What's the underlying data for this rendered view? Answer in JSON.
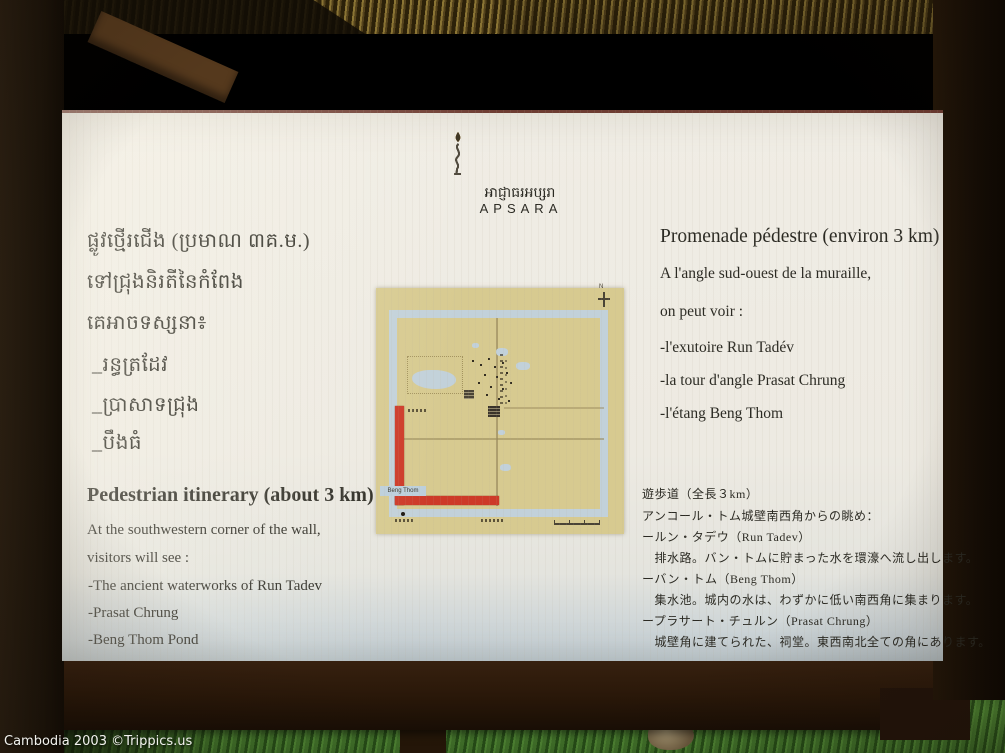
{
  "watermark": "Cambodia 2003 ©Trippics.us",
  "sign": {
    "logo": {
      "khmer_name": "អាជ្ញាធរអប្សរា",
      "latin_name": "APSARA",
      "drop_colors": [
        "#2e2e3c",
        "#d18a2e",
        "#2f4d28",
        "#c47a2e",
        "#3a321f"
      ]
    },
    "khmer": {
      "title": "ផ្លូវថ្មើរជើង (ប្រមាណ ៣គ.ម.)",
      "line2": "ទៅជ្រុងនិរតីនៃកំពែង",
      "line3": "គេអាចទស្សនា៖",
      "item1": "_រន្ធត្រដែវ",
      "item2": "_ប្រាសាទជ្រុង",
      "item3": "_បឹងធំ"
    },
    "french": {
      "title": "Promenade pédestre (environ 3 km)",
      "line1": "A l'angle sud-ouest de la muraille,",
      "line2": "on peut voir :",
      "item1": "-l'exutoire Run Tadév",
      "item2": "-la tour d'angle Prasat Chrung",
      "item3": "-l'étang Beng Thom"
    },
    "english": {
      "title": "Pedestrian itinerary (about 3 km)",
      "line1": "At the southwestern corner of the wall,",
      "line2": "visitors will see :",
      "item1": "-The ancient waterworks of Run Tadev",
      "item2": "-Prasat Chrung",
      "item3": "-Beng Thom Pond"
    },
    "japanese": {
      "title": "遊歩道（全長３km）",
      "line1": "アンコール・トム城壁南西角からの眺め：",
      "item1": "ールン・タデウ（Run Tadev）",
      "desc1": "　排水路。バン・トムに貯まった水を環濠へ流し出します。",
      "item2": "ーバン・トム（Beng Thom）",
      "desc2": "　集水池。城内の水は、わずかに低い南西角に集まります。",
      "item3": "ープラサート・チュルン（Prasat Chrung）",
      "desc3": "　城壁角に建てられた、祠堂。東西南北全ての角にあります。"
    },
    "map": {
      "corner_label": "Beng Thom",
      "compass_label": "N",
      "colors": {
        "ground": "#d7ca90",
        "moat": "#c2d1da",
        "route": "#cd3a28"
      }
    }
  }
}
